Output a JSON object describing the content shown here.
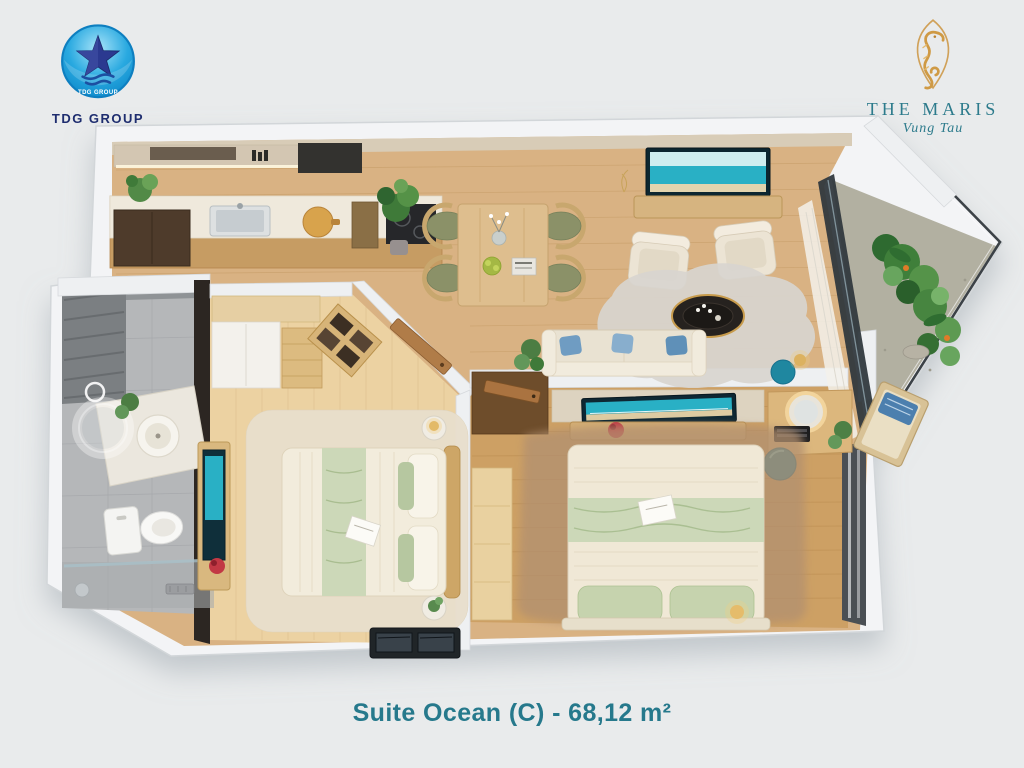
{
  "branding": {
    "tdg_group": {
      "logo_text": "TDG GROUP",
      "wordmark": "TDG GROUP"
    },
    "the_maris": {
      "wordmark": "THE MARIS",
      "location_script": "Vung Tau"
    }
  },
  "caption": {
    "text": "Suite Ocean (C) - 68,12 m²"
  },
  "colors": {
    "background": "#e9ebec",
    "wall_outer": "#f3f4f6",
    "wall_inner": "#eef0f2",
    "wood_main": "#d9b283",
    "wood_bedroom1": "#ecd2a2",
    "wood_bedroom2": "#cda064",
    "bath_tile": "#b5b7b9",
    "balcony_floor": "#b2b0a1",
    "dark_wall": "#2c2622",
    "accent_teal": "#1f87a0",
    "tv_screen_teal": "#29b0c5",
    "cushion_olive": "#8b9168",
    "bedding_green": "#ccd8b8",
    "rug_living": "#d8d5cf",
    "rug_bedroom2": "#b29070",
    "sofa_cream": "#e9e2d2",
    "tdg_blue": "#29a9e0",
    "tdg_navy": "#1e2d6f",
    "maris_gold": "#cf9a45",
    "maris_teal": "#2d7b8c"
  }
}
